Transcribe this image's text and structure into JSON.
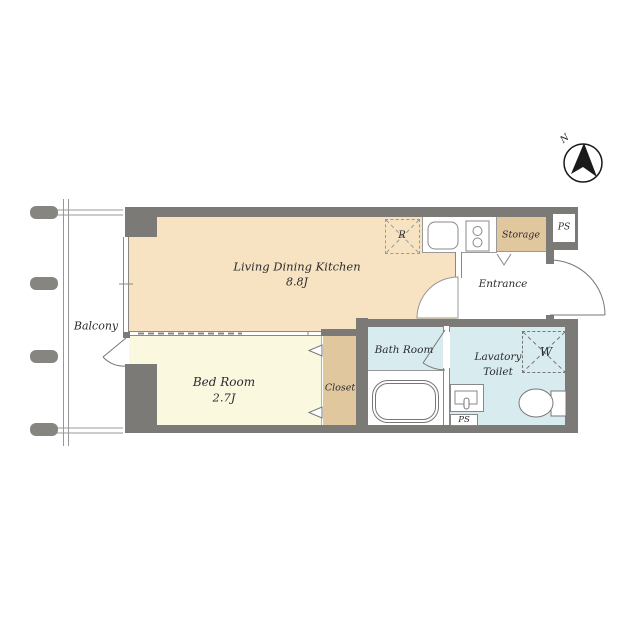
{
  "compass": {
    "label": "N"
  },
  "balcony": {
    "label": "Balcony"
  },
  "rooms": {
    "ldk": {
      "name": "Living Dining Kitchen",
      "size": "8.8J"
    },
    "bedroom": {
      "name": "Bed Room",
      "size": "2.7J"
    },
    "closet": {
      "name": "Closet"
    },
    "bathroom": {
      "name": "Bath Room"
    },
    "lavatory": {
      "line1": "Lavatory",
      "line2": "Toilet"
    },
    "entrance": {
      "name": "Entrance"
    },
    "storage": {
      "name": "Storage"
    }
  },
  "fixtures": {
    "refrigerator": {
      "label": "R"
    },
    "washer": {
      "label": "W"
    },
    "ps_upper": {
      "label": "PS"
    },
    "ps_lower": {
      "label": "PS"
    }
  },
  "colors": {
    "wall": "#7c7a77",
    "ldk_floor": "#f7e3c1",
    "bedroom_floor": "#fbf8e0",
    "wood": "#e0c79e",
    "wet_area": "#d8ecf0",
    "fixture_line": "#888888",
    "text": "#2b2b30"
  }
}
